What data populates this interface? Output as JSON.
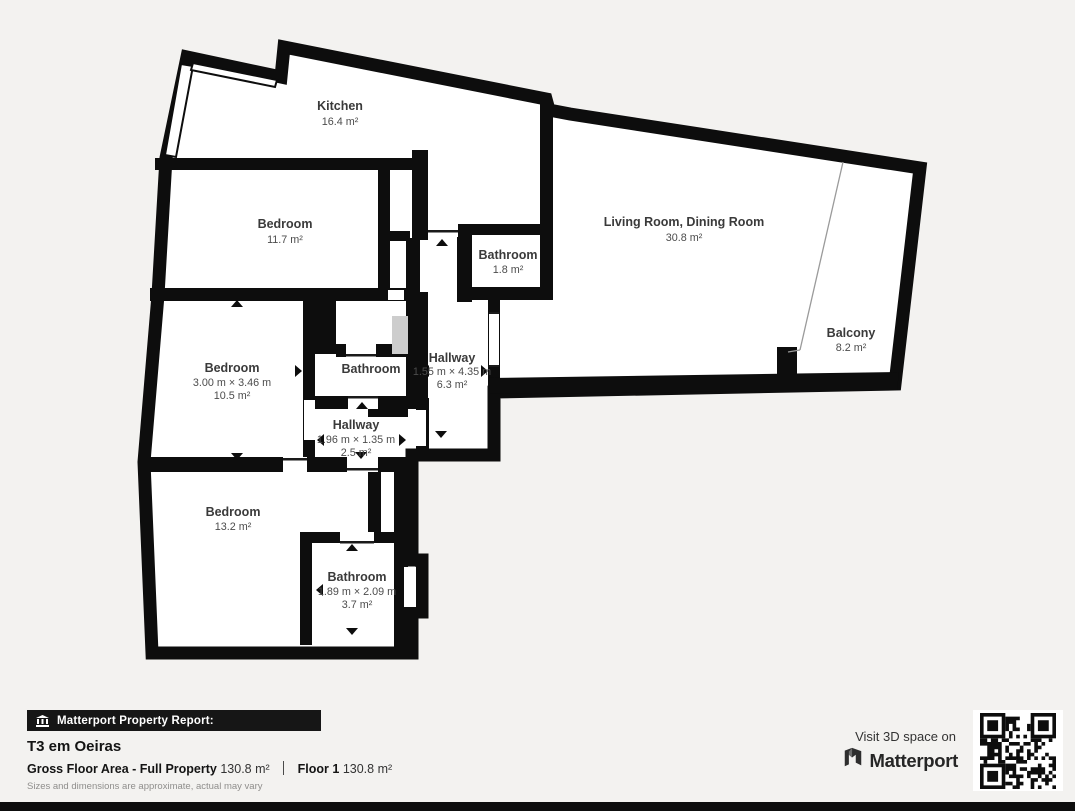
{
  "rooms": {
    "kitchen": {
      "name": "Kitchen",
      "area": "16.4 m²"
    },
    "bedroom_top": {
      "name": "Bedroom",
      "area": "11.7 m²"
    },
    "living": {
      "name": "Living Room, Dining Room",
      "area": "30.8 m²"
    },
    "bathroom_small": {
      "name": "Bathroom",
      "area": "1.8 m²"
    },
    "bedroom_mid": {
      "name": "Bedroom",
      "dims": "3.00 m × 3.46 m",
      "area": "10.5 m²"
    },
    "bathroom_mid": {
      "name": "Bathroom"
    },
    "hallway_main": {
      "name": "Hallway",
      "dims": "1.55 m × 4.35 m",
      "area": "6.3 m²"
    },
    "hallway_small": {
      "name": "Hallway",
      "dims": "1.96 m × 1.35 m",
      "area": "2.5 m²"
    },
    "bedroom_bottom": {
      "name": "Bedroom",
      "area": "13.2 m²"
    },
    "bathroom_bottom": {
      "name": "Bathroom",
      "dims": "1.89 m × 2.09 m",
      "area": "3.7 m²"
    },
    "balcony": {
      "name": "Balcony",
      "area": "8.2 m²"
    }
  },
  "report": {
    "badge_label": "Matterport Property Report:",
    "title": "T3 em Oeiras",
    "gross_floor_area_label": "Gross Floor Area - Full Property",
    "gross_floor_area_value": "130.8 m²",
    "floor_label": "Floor 1",
    "floor_value": "130.8 m²",
    "disclaimer": "Sizes and dimensions are approximate, actual may vary"
  },
  "cta": {
    "visit_label": "Visit 3D space on",
    "brand": "Matterport"
  },
  "colors": {
    "wall": "#0d0d0d",
    "background": "#f3f2f0",
    "room_fill": "#ffffff",
    "label_text": "#3a3a3a"
  }
}
